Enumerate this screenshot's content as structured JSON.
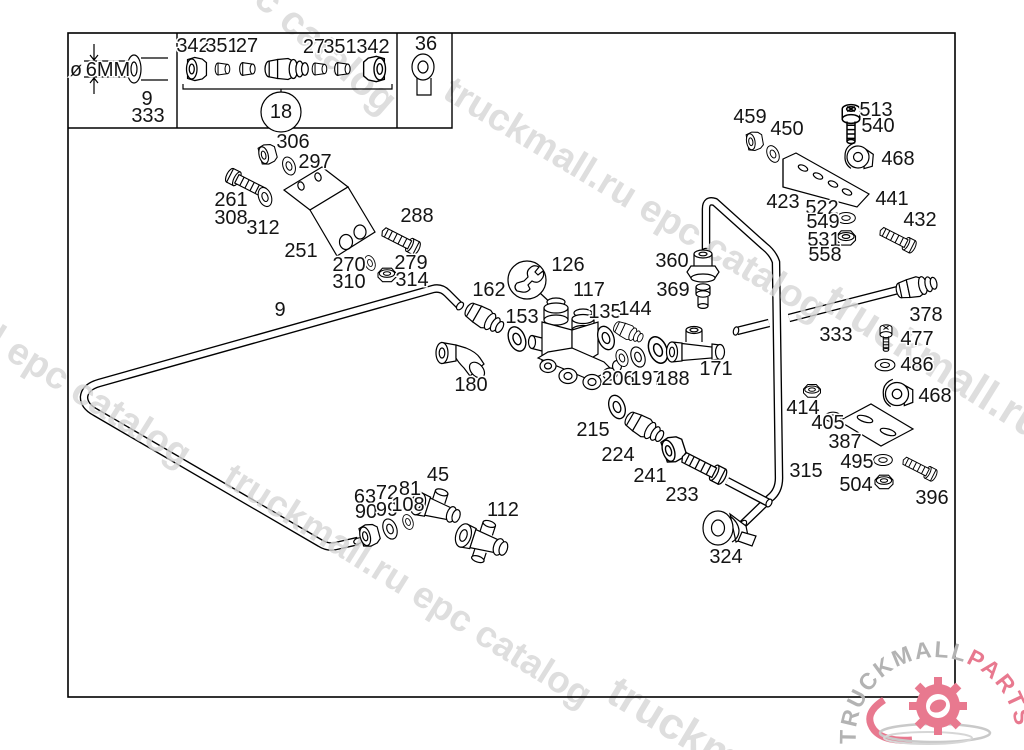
{
  "legend": {
    "phi": "ø",
    "diameter": "6MM",
    "pipe_ref": "9",
    "pipe_part": "333",
    "group_left": [
      "342",
      "351",
      "27"
    ],
    "group_right": [
      "27",
      "351",
      "342"
    ],
    "group_circle": "18",
    "single_part": "36"
  },
  "diagram": {
    "labels": [
      {
        "text": "ø",
        "x": 76,
        "y": 76,
        "size": 17
      },
      {
        "text": "6MM",
        "x": 108,
        "y": 76,
        "size": 18
      },
      {
        "text": "9",
        "x": 147,
        "y": 105
      },
      {
        "text": "333",
        "x": 148,
        "y": 122
      },
      {
        "text": "342",
        "x": 193,
        "y": 52
      },
      {
        "text": "351",
        "x": 222,
        "y": 52
      },
      {
        "text": "27",
        "x": 247,
        "y": 52
      },
      {
        "text": "27",
        "x": 314,
        "y": 53
      },
      {
        "text": "351",
        "x": 340,
        "y": 53
      },
      {
        "text": "342",
        "x": 373,
        "y": 53
      },
      {
        "text": "18",
        "x": 281,
        "y": 118
      },
      {
        "text": "36",
        "x": 426,
        "y": 50
      },
      {
        "text": "306",
        "x": 293,
        "y": 148
      },
      {
        "text": "297",
        "x": 315,
        "y": 168
      },
      {
        "text": "261",
        "x": 231,
        "y": 206
      },
      {
        "text": "308",
        "x": 231,
        "y": 224
      },
      {
        "text": "312",
        "x": 263,
        "y": 234
      },
      {
        "text": "251",
        "x": 301,
        "y": 257
      },
      {
        "text": "288",
        "x": 417,
        "y": 222
      },
      {
        "text": "270",
        "x": 349,
        "y": 271
      },
      {
        "text": "310",
        "x": 349,
        "y": 288
      },
      {
        "text": "279",
        "x": 411,
        "y": 269
      },
      {
        "text": "314",
        "x": 412,
        "y": 286
      },
      {
        "text": "9",
        "x": 280,
        "y": 316
      },
      {
        "text": "126",
        "x": 568,
        "y": 271
      },
      {
        "text": "162",
        "x": 489,
        "y": 296
      },
      {
        "text": "117",
        "x": 589,
        "y": 296
      },
      {
        "text": "153",
        "x": 522,
        "y": 323
      },
      {
        "text": "135",
        "x": 605,
        "y": 318
      },
      {
        "text": "144",
        "x": 635,
        "y": 315
      },
      {
        "text": "206",
        "x": 618,
        "y": 385
      },
      {
        "text": "197",
        "x": 647,
        "y": 385
      },
      {
        "text": "188",
        "x": 673,
        "y": 385
      },
      {
        "text": "180",
        "x": 471,
        "y": 391
      },
      {
        "text": "215",
        "x": 593,
        "y": 436
      },
      {
        "text": "224",
        "x": 618,
        "y": 461
      },
      {
        "text": "241",
        "x": 650,
        "y": 482
      },
      {
        "text": "233",
        "x": 682,
        "y": 501
      },
      {
        "text": "45",
        "x": 438,
        "y": 481
      },
      {
        "text": "63",
        "x": 365,
        "y": 503
      },
      {
        "text": "72",
        "x": 387,
        "y": 499
      },
      {
        "text": "81",
        "x": 410,
        "y": 495
      },
      {
        "text": "90",
        "x": 366,
        "y": 518
      },
      {
        "text": "99",
        "x": 387,
        "y": 516
      },
      {
        "text": "108",
        "x": 408,
        "y": 511
      },
      {
        "text": "112",
        "x": 503,
        "y": 516
      },
      {
        "text": "360",
        "x": 672,
        "y": 267
      },
      {
        "text": "369",
        "x": 673,
        "y": 296
      },
      {
        "text": "171",
        "x": 716,
        "y": 375
      },
      {
        "text": "333",
        "x": 836,
        "y": 341
      },
      {
        "text": "459",
        "x": 750,
        "y": 123
      },
      {
        "text": "450",
        "x": 787,
        "y": 135
      },
      {
        "text": "513",
        "x": 876,
        "y": 116
      },
      {
        "text": "540",
        "x": 878,
        "y": 132
      },
      {
        "text": "468",
        "x": 898,
        "y": 165
      },
      {
        "text": "423",
        "x": 783,
        "y": 208
      },
      {
        "text": "441",
        "x": 892,
        "y": 205
      },
      {
        "text": "522",
        "x": 822,
        "y": 214
      },
      {
        "text": "549",
        "x": 823,
        "y": 228
      },
      {
        "text": "531",
        "x": 824,
        "y": 246
      },
      {
        "text": "558",
        "x": 825,
        "y": 261
      },
      {
        "text": "432",
        "x": 920,
        "y": 226
      },
      {
        "text": "378",
        "x": 926,
        "y": 321
      },
      {
        "text": "477",
        "x": 917,
        "y": 345
      },
      {
        "text": "486",
        "x": 917,
        "y": 371
      },
      {
        "text": "468",
        "x": 935,
        "y": 402
      },
      {
        "text": "414",
        "x": 803,
        "y": 414
      },
      {
        "text": "405",
        "x": 828,
        "y": 429
      },
      {
        "text": "387",
        "x": 845,
        "y": 448
      },
      {
        "text": "495",
        "x": 857,
        "y": 468
      },
      {
        "text": "504",
        "x": 856,
        "y": 491
      },
      {
        "text": "396",
        "x": 932,
        "y": 504
      },
      {
        "text": "315",
        "x": 806,
        "y": 477
      },
      {
        "text": "324",
        "x": 726,
        "y": 563
      }
    ]
  },
  "watermarks": [
    {
      "text": "c catalog",
      "x": 252,
      "y": 2,
      "rot": 41,
      "size": 40
    },
    {
      "text": "truckmall.ru epc catalog",
      "x": 441,
      "y": 97,
      "rot": 31,
      "size": 38
    },
    {
      "text": "l epc catalog",
      "x": -14,
      "y": 346,
      "rot": 32,
      "size": 38
    },
    {
      "text": "truckmall.ru epc catalog",
      "x": 221,
      "y": 483,
      "rot": 32,
      "size": 37
    },
    {
      "text": "truckmall.ru e",
      "x": 820,
      "y": 308,
      "rot": 32,
      "size": 44
    },
    {
      "text": "truckm",
      "x": 604,
      "y": 700,
      "rot": 31,
      "size": 44
    }
  ],
  "logo": {
    "brand": "TRUCKMALL",
    "suffix": "PARTS",
    "brand_color": "#b3b3b3",
    "suffix_color": "#e8798f"
  },
  "colors": {
    "line": "#000000",
    "watermark": "#d6d6d6",
    "logo_pink": "#e8798f",
    "logo_gray": "#b3b3b3",
    "background": "#ffffff"
  }
}
